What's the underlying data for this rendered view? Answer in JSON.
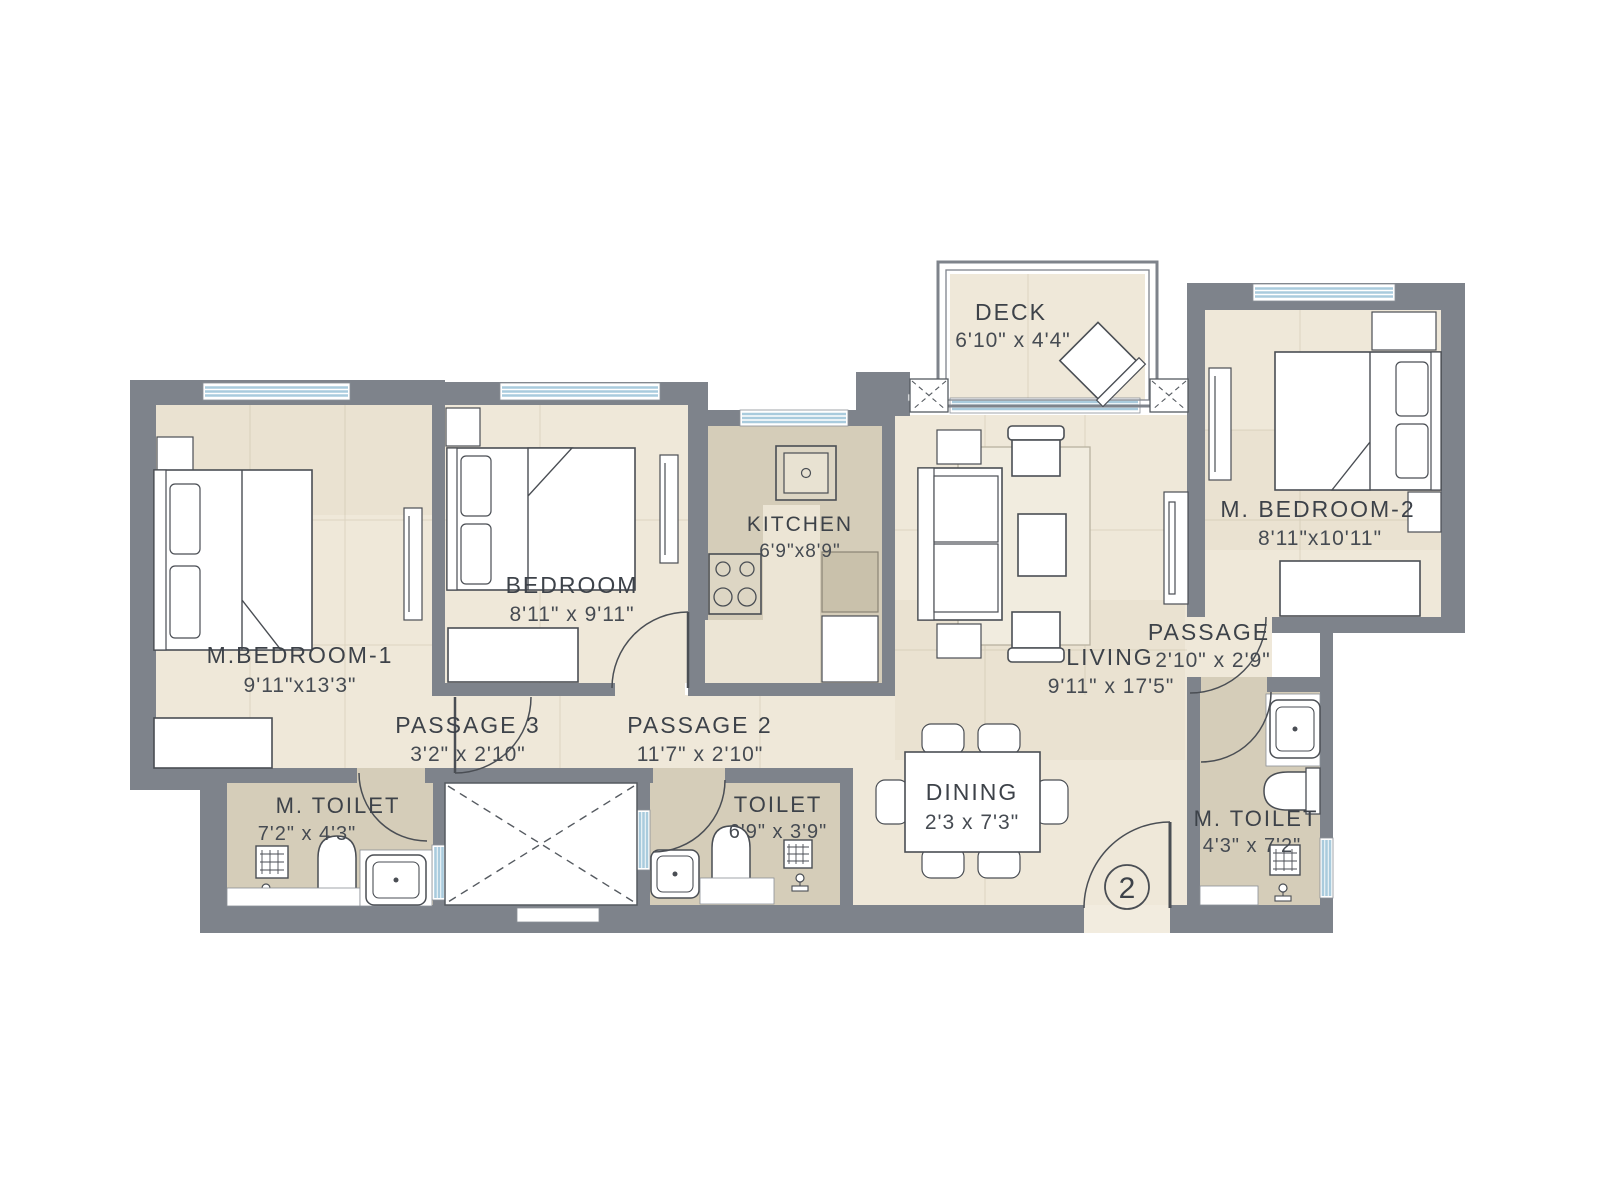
{
  "plan": {
    "type": "apartment-floor-plan",
    "unit_label": "2",
    "rooms": {
      "mbr1": {
        "name": "M.BEDROOM-1",
        "dims": "9'11\"x13'3\""
      },
      "bedroom": {
        "name": "BEDROOM",
        "dims": "8'11\" x 9'11\""
      },
      "kitchen": {
        "name": "KITCHEN",
        "dims": "6'9\"x8'9\""
      },
      "deck": {
        "name": "DECK",
        "dims": "6'10\" x 4'4\""
      },
      "living": {
        "name": "LIVING",
        "dims": "9'11\" x 17'5\""
      },
      "mbr2": {
        "name": "M. BEDROOM-2",
        "dims": "8'11\"x10'11\""
      },
      "passage": {
        "name": "PASSAGE",
        "dims": "2'10\" x 2'9\""
      },
      "passage2": {
        "name": "PASSAGE 2",
        "dims": "11'7\" x 2'10\""
      },
      "passage3": {
        "name": "PASSAGE 3",
        "dims": "3'2\" x 2'10\""
      },
      "mtoilet1": {
        "name": "M. TOILET",
        "dims": "7'2\" x 4'3\""
      },
      "toilet": {
        "name": "TOILET",
        "dims": "6'9\" x 3'9\""
      },
      "dining": {
        "name": "DINING",
        "dims": "2'3 x 7'3\""
      },
      "mtoilet2": {
        "name": "M. TOILET",
        "dims": "4'3\" x 7'2\""
      }
    },
    "colors": {
      "background": "#ffffff",
      "wall": "#7e838b",
      "floor": "#efe8d9",
      "wet_floor": "#d5cdb9",
      "window_glass": "#a9cbdd",
      "furniture_line": "#4a4e54",
      "text": "#3d4249"
    }
  }
}
